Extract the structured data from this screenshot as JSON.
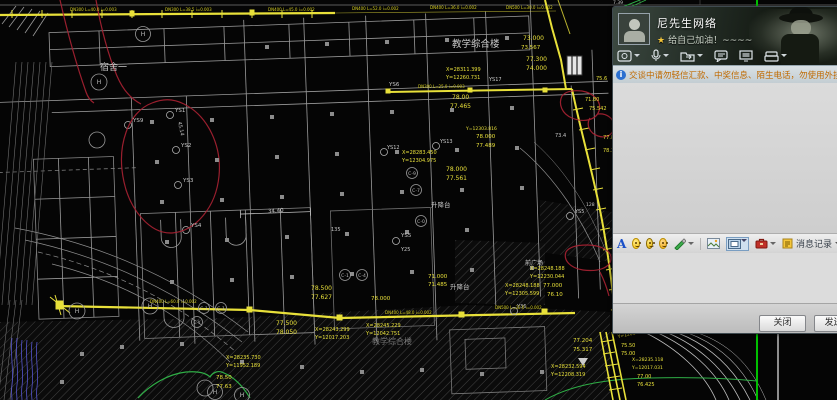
{
  "chat": {
    "title": "尼先生网络",
    "signature": "给自己加油！~~~~",
    "notice": "交谈中请勿轻信汇款、中奖信息、陌生电话，勿使用外挂软件",
    "message_log_label": "消息记录",
    "close_button": "关闭(C)",
    "send_button": "发送(S)",
    "banner_icons": [
      "video-call",
      "voice-call",
      "send-file",
      "multi-chat",
      "remote-demo",
      "app-share"
    ],
    "input_icons": [
      "font",
      "emoticon",
      "magic-emoticon",
      "shake-emoticon",
      "screenshot",
      "send-picture",
      "screen-capture",
      "toolbox"
    ],
    "colors": {
      "notice_text": "#c06a00",
      "title_text": "#ffffff",
      "accent_star": "#f4c63a"
    }
  },
  "cad": {
    "colors": {
      "line": "#9f9f9f",
      "pipe": "#e8e03a",
      "annotation": "#aa2233",
      "survey": "#2fae46",
      "water": "#5555cc"
    },
    "white_labels": [
      {
        "x": 100,
        "y": 70,
        "t": "宿舍一",
        "s": 9
      },
      {
        "x": 452,
        "y": 47,
        "t": "教学综合楼",
        "s": 9.5
      },
      {
        "x": 372,
        "y": 344,
        "t": "教学综合楼",
        "s": 8,
        "o": 0.55
      },
      {
        "x": 431,
        "y": 207,
        "t": "升降台",
        "s": 6.5
      },
      {
        "x": 450,
        "y": 289,
        "t": "升降台",
        "s": 6.5
      },
      {
        "x": 525,
        "y": 265,
        "t": "前广场",
        "s": 6
      },
      {
        "x": 175,
        "y": 112,
        "t": "YS1",
        "s": 5.5
      },
      {
        "x": 181,
        "y": 147,
        "t": "YS2",
        "s": 5.5
      },
      {
        "x": 183,
        "y": 182,
        "t": "YS3",
        "s": 5.5
      },
      {
        "x": 191,
        "y": 227,
        "t": "YS4",
        "s": 5.5
      },
      {
        "x": 401,
        "y": 237,
        "t": "YS5",
        "s": 5.5
      },
      {
        "x": 133,
        "y": 122,
        "t": "YS9",
        "s": 5.5
      },
      {
        "x": 387,
        "y": 149,
        "t": "YS12",
        "s": 5
      },
      {
        "x": 440,
        "y": 143,
        "t": "YS13",
        "s": 5
      },
      {
        "x": 331,
        "y": 231,
        "t": "135",
        "s": 5
      },
      {
        "x": 401,
        "y": 251,
        "t": "Y25",
        "s": 5
      },
      {
        "x": 517,
        "y": 308,
        "t": "Y36",
        "s": 5
      },
      {
        "x": 575,
        "y": 213,
        "t": "YS5",
        "s": 5
      },
      {
        "x": 586,
        "y": 206,
        "t": "128",
        "s": 4.5
      },
      {
        "x": 555,
        "y": 137,
        "t": "73.4",
        "s": 5
      },
      {
        "x": 389,
        "y": 86,
        "t": "YS6",
        "s": 5.5
      },
      {
        "x": 489,
        "y": 81,
        "t": "YS17",
        "s": 5
      },
      {
        "x": 268,
        "y": 213,
        "t": "34.40",
        "s": 5.5,
        "r": -4
      },
      {
        "x": 178,
        "y": 122,
        "t": "45.14",
        "s": 5,
        "r": 78
      },
      {
        "x": 613,
        "y": 4,
        "t": "7.39",
        "s": 4.5
      }
    ],
    "yellow_labels": [
      {
        "x": 523,
        "y": 40,
        "t": "73.000",
        "s": 6
      },
      {
        "x": 521,
        "y": 49,
        "t": "73.567",
        "s": 5.5
      },
      {
        "x": 526,
        "y": 61,
        "t": "77.300",
        "s": 6
      },
      {
        "x": 526,
        "y": 70,
        "t": "74.000",
        "s": 6
      },
      {
        "x": 446,
        "y": 71,
        "t": "X=28311.399",
        "s": 5
      },
      {
        "x": 446,
        "y": 79,
        "t": "Y=12260.731",
        "s": 5
      },
      {
        "x": 452,
        "y": 99,
        "t": "78.00",
        "s": 6
      },
      {
        "x": 450,
        "y": 108,
        "t": "77.465",
        "s": 6
      },
      {
        "x": 585,
        "y": 101,
        "t": "71.80",
        "s": 5
      },
      {
        "x": 589,
        "y": 110,
        "t": "75.542",
        "s": 5
      },
      {
        "x": 596,
        "y": 80,
        "t": "75.6",
        "s": 5
      },
      {
        "x": 402,
        "y": 154,
        "t": "X=28283.450",
        "s": 5
      },
      {
        "x": 402,
        "y": 162,
        "t": "Y=12304.975",
        "s": 5
      },
      {
        "x": 446,
        "y": 171,
        "t": "78.000",
        "s": 6
      },
      {
        "x": 446,
        "y": 180,
        "t": "77.561",
        "s": 6
      },
      {
        "x": 476,
        "y": 138,
        "t": "78.000",
        "s": 5.5
      },
      {
        "x": 476,
        "y": 147,
        "t": "77.489",
        "s": 5.5
      },
      {
        "x": 466,
        "y": 130,
        "t": "Y=12303.816",
        "s": 4.5
      },
      {
        "x": 311,
        "y": 290,
        "t": "78.500",
        "s": 6
      },
      {
        "x": 311,
        "y": 299,
        "t": "77.627",
        "s": 6
      },
      {
        "x": 371,
        "y": 300,
        "t": "78.000",
        "s": 5.5
      },
      {
        "x": 276,
        "y": 325,
        "t": "77.500",
        "s": 6
      },
      {
        "x": 276,
        "y": 334,
        "t": "78.050",
        "s": 6
      },
      {
        "x": 315,
        "y": 331,
        "t": "X=28243.299",
        "s": 5
      },
      {
        "x": 315,
        "y": 339,
        "t": "Y=12017.203",
        "s": 5
      },
      {
        "x": 366,
        "y": 327,
        "t": "X=28245.229",
        "s": 5
      },
      {
        "x": 366,
        "y": 335,
        "t": "Y=12042.751",
        "s": 5
      },
      {
        "x": 530,
        "y": 270,
        "t": "X=28248.188",
        "s": 5
      },
      {
        "x": 530,
        "y": 278,
        "t": "Y=12230.044",
        "s": 5
      },
      {
        "x": 505,
        "y": 287,
        "t": "X=28248.188",
        "s": 5
      },
      {
        "x": 505,
        "y": 295,
        "t": "Y=12305.599",
        "s": 5
      },
      {
        "x": 543,
        "y": 287,
        "t": "77.000",
        "s": 5.5
      },
      {
        "x": 547,
        "y": 296,
        "t": "76.10",
        "s": 5.5
      },
      {
        "x": 428,
        "y": 278,
        "t": "71.000",
        "s": 5.5
      },
      {
        "x": 428,
        "y": 286,
        "t": "71.485",
        "s": 5.5
      },
      {
        "x": 573,
        "y": 342,
        "t": "77.204",
        "s": 5.5
      },
      {
        "x": 573,
        "y": 351,
        "t": "75.317",
        "s": 5.5
      },
      {
        "x": 551,
        "y": 368,
        "t": "X=28232.594",
        "s": 5
      },
      {
        "x": 551,
        "y": 376,
        "t": "Y=12208.319",
        "s": 5
      },
      {
        "x": 226,
        "y": 359,
        "t": "X=28235.730",
        "s": 5
      },
      {
        "x": 226,
        "y": 367,
        "t": "Y=11952.189",
        "s": 5
      },
      {
        "x": 216,
        "y": 379,
        "t": "78.50",
        "s": 5.5
      },
      {
        "x": 216,
        "y": 388,
        "t": "77.63",
        "s": 5.5
      },
      {
        "x": 616,
        "y": 329,
        "t": "X=28234.043",
        "s": 4.5,
        "r": -12
      },
      {
        "x": 618,
        "y": 338,
        "t": "Y=12018.045",
        "s": 4.5,
        "r": -12
      },
      {
        "x": 621,
        "y": 347,
        "t": "75.50",
        "s": 5
      },
      {
        "x": 621,
        "y": 355,
        "t": "75.00",
        "s": 5
      },
      {
        "x": 632,
        "y": 361,
        "t": "X=28235.118",
        "s": 4.5
      },
      {
        "x": 632,
        "y": 369,
        "t": "Y=12017.031",
        "s": 4.5
      },
      {
        "x": 637,
        "y": 378,
        "t": "77.00",
        "s": 5
      },
      {
        "x": 637,
        "y": 386,
        "t": "76.425",
        "s": 5
      },
      {
        "x": 603,
        "y": 139,
        "t": "77.8",
        "s": 5
      },
      {
        "x": 603,
        "y": 152,
        "t": "78.3",
        "s": 5
      }
    ],
    "pipe_labels": [
      {
        "x": 70,
        "y": 11,
        "t": "DN300 L=40.0 i=0.003"
      },
      {
        "x": 165,
        "y": 11,
        "t": "DN300 L=38.5 i=0.003"
      },
      {
        "x": 268,
        "y": 11,
        "t": "DN400 L=45.0 i=0.002"
      },
      {
        "x": 352,
        "y": 10,
        "t": "DN400 L=52.0 i=0.002"
      },
      {
        "x": 430,
        "y": 9,
        "t": "DN400 L=36.0 i=0.002"
      },
      {
        "x": 506,
        "y": 9,
        "t": "DN500 L=30.0 i=0.002"
      },
      {
        "x": 418,
        "y": 88,
        "t": "DN300 L=25.0 i=0.003"
      },
      {
        "x": 150,
        "y": 303,
        "t": "DN400 L=60.0 i=0.002"
      },
      {
        "x": 385,
        "y": 314,
        "t": "DN400 L=48.0 i=0.002"
      },
      {
        "x": 495,
        "y": 309,
        "t": "DN500 L=32.0 i=0.002"
      }
    ],
    "bubble_labels": [
      {
        "x": 345,
        "y": 275,
        "t": "C-1",
        "r": 5.5
      },
      {
        "x": 362,
        "y": 275,
        "t": "C-4",
        "r": 5.5
      },
      {
        "x": 204,
        "y": 308,
        "t": "C-1",
        "r": 5.5
      },
      {
        "x": 221,
        "y": 308,
        "t": "C-1",
        "r": 5.5
      },
      {
        "x": 197,
        "y": 322,
        "t": "C-Y",
        "r": 5.5
      },
      {
        "x": 412,
        "y": 173,
        "t": "C-9",
        "r": 5.5
      },
      {
        "x": 416,
        "y": 190,
        "t": "C-7",
        "r": 5.5
      },
      {
        "x": 421,
        "y": 221,
        "t": "C-0",
        "r": 5.5
      },
      {
        "x": 143,
        "y": 34,
        "t": "H",
        "r": 7.5
      },
      {
        "x": 99,
        "y": 82,
        "t": "H",
        "r": 8
      },
      {
        "x": 150,
        "y": 306,
        "t": "H",
        "r": 8
      },
      {
        "x": 77,
        "y": 311,
        "t": "H",
        "r": 8
      },
      {
        "x": 215,
        "y": 392,
        "t": "H",
        "r": 7.5
      },
      {
        "x": 242,
        "y": 395,
        "t": "H",
        "r": 7.5
      }
    ]
  }
}
